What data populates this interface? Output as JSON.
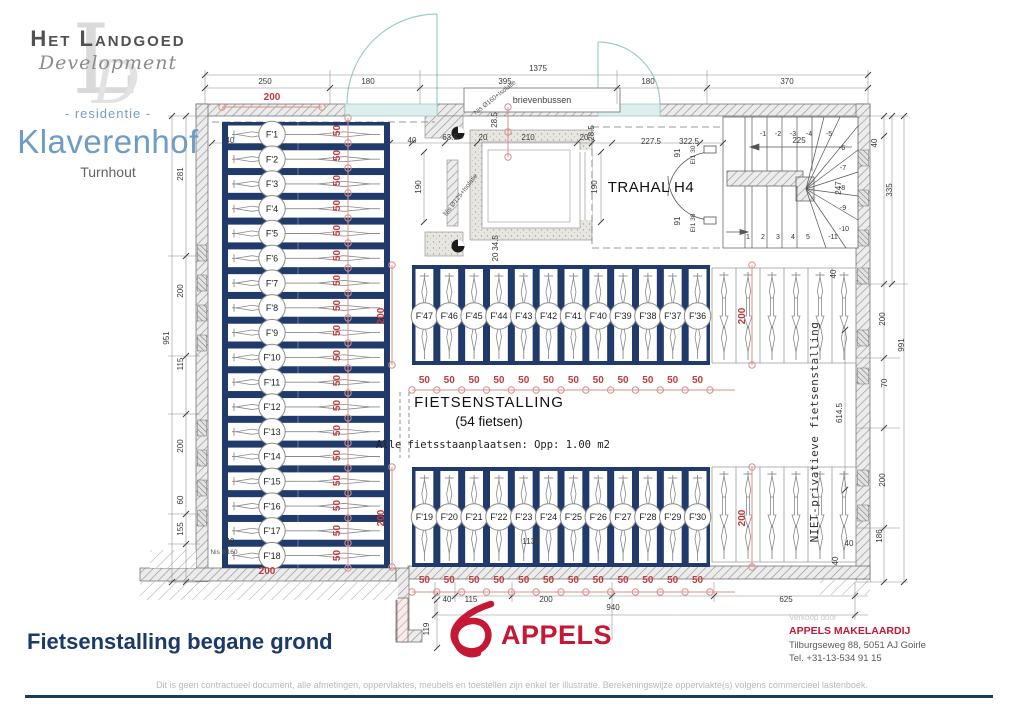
{
  "branding": {
    "company": "Het Landgoed",
    "development": "Development",
    "watermark1": "L",
    "watermark2": "D",
    "residentie": "- residentie -",
    "project": "Klaverenhof",
    "city": "Turnhout"
  },
  "title": "Fietsenstalling begane grond",
  "colors": {
    "navy": "#1f3a6b",
    "dim_red": "#c23b3b",
    "dim_red_light": "#d98f8a",
    "teal": "#9ccfce",
    "appels_red": "#c41834",
    "title_navy": "#1c3a69"
  },
  "plan": {
    "room_title": "FIETSENSTALLING",
    "room_subtitle": "(54 fietsen)",
    "room_note": "Alle fietsstaanplaatsen: Opp: 1.00 m2",
    "hall_label": "TRAHAL H4",
    "mailbox_label": "brievenbussen",
    "private_label": "NIET-privatieve fietsenstalling",
    "door_label": "EI1 30",
    "fifty": "50",
    "nis_labels": [
      {
        "t": "Nis Ø160+Isolatie",
        "x": 496,
        "y": 99,
        "r": -38
      },
      {
        "t": "Nis Ø125+Isolatie",
        "x": 462,
        "y": 196,
        "r": -52
      },
      {
        "t": "Nis Ø160",
        "x": 224,
        "y": 554,
        "r": 0
      }
    ],
    "left_stalls": [
      "F'1",
      "F'2",
      "F'3",
      "F'4",
      "F'5",
      "F'6",
      "F'7",
      "F'8",
      "F'9",
      "F'10",
      "F'11",
      "F'12",
      "F'13",
      "F'14",
      "F'15",
      "F'16",
      "F'17",
      "F'18"
    ],
    "top_stalls": [
      "F'47",
      "F'46",
      "F'45",
      "F'44",
      "F'43",
      "F'42",
      "F'41",
      "F'40",
      "F'39",
      "F'38",
      "F'37",
      "F'36"
    ],
    "bottom_stalls": [
      "F'19",
      "F'20",
      "F'21",
      "F'22",
      "F'23",
      "F'24",
      "F'25",
      "F'26",
      "F'27",
      "F'28",
      "F'29",
      "F'30"
    ],
    "stair_steps": {
      "top": [
        "-1",
        "-2",
        "-3",
        "-4",
        "-5"
      ],
      "right": [
        "-6",
        "-7",
        "-8",
        "-9",
        "-10",
        "-11"
      ],
      "bottom": [
        "1",
        "2",
        "3",
        "4",
        "5"
      ]
    },
    "red_dims": [
      {
        "t": "200",
        "x": 272,
        "y": 100
      },
      {
        "t": "200",
        "x": 267,
        "y": 574
      },
      {
        "t": "200",
        "x": 384,
        "y": 316,
        "r": -90
      },
      {
        "t": "200",
        "x": 384,
        "y": 518,
        "r": -90
      },
      {
        "t": "200",
        "x": 745,
        "y": 316,
        "r": -90
      },
      {
        "t": "200",
        "x": 745,
        "y": 518,
        "r": -90
      }
    ],
    "black_dims": [
      {
        "t": "1375",
        "x": 538,
        "y": 71
      },
      {
        "t": "250",
        "x": 265,
        "y": 84
      },
      {
        "t": "180",
        "x": 368,
        "y": 84
      },
      {
        "t": "395",
        "x": 505,
        "y": 84
      },
      {
        "t": "180",
        "x": 648,
        "y": 84
      },
      {
        "t": "370",
        "x": 787,
        "y": 84
      },
      {
        "t": "281",
        "x": 183,
        "y": 174,
        "r": -90
      },
      {
        "t": "200",
        "x": 183,
        "y": 291,
        "r": -90
      },
      {
        "t": "115",
        "x": 183,
        "y": 364,
        "r": -90
      },
      {
        "t": "200",
        "x": 183,
        "y": 446,
        "r": -90
      },
      {
        "t": "60",
        "x": 183,
        "y": 500,
        "r": -90
      },
      {
        "t": "155",
        "x": 183,
        "y": 529,
        "r": -90
      },
      {
        "t": "951",
        "x": 169,
        "y": 338,
        "r": -90
      },
      {
        "t": "40",
        "x": 877,
        "y": 143,
        "r": -90
      },
      {
        "t": "335",
        "x": 892,
        "y": 190,
        "r": -90
      },
      {
        "t": "200",
        "x": 885,
        "y": 319,
        "r": -90
      },
      {
        "t": "70",
        "x": 887,
        "y": 383,
        "r": -90
      },
      {
        "t": "200",
        "x": 885,
        "y": 480,
        "r": -90
      },
      {
        "t": "186",
        "x": 882,
        "y": 536,
        "r": -90
      },
      {
        "t": "991",
        "x": 904,
        "y": 345,
        "r": -90
      },
      {
        "t": "40",
        "x": 447,
        "y": 602
      },
      {
        "t": "115",
        "x": 471,
        "y": 602
      },
      {
        "t": "200",
        "x": 546,
        "y": 602
      },
      {
        "t": "625",
        "x": 786,
        "y": 602
      },
      {
        "t": "940",
        "x": 613,
        "y": 610
      },
      {
        "t": "119",
        "x": 429,
        "y": 629,
        "r": -90
      },
      {
        "t": "40",
        "x": 230,
        "y": 143
      },
      {
        "t": "40",
        "x": 412,
        "y": 143
      },
      {
        "t": "63.5",
        "x": 450,
        "y": 140
      },
      {
        "t": "20",
        "x": 483,
        "y": 140
      },
      {
        "t": "210",
        "x": 528,
        "y": 140
      },
      {
        "t": "20",
        "x": 584,
        "y": 140
      },
      {
        "t": "28.5",
        "x": 497,
        "y": 120,
        "r": -90
      },
      {
        "t": "28.5",
        "x": 594,
        "y": 133,
        "r": -90
      },
      {
        "t": "190",
        "x": 421,
        "y": 187,
        "r": -90
      },
      {
        "t": "190",
        "x": 597,
        "y": 187,
        "r": -90
      },
      {
        "t": "34.5",
        "x": 498,
        "y": 243,
        "r": -90
      },
      {
        "t": "20",
        "x": 498,
        "y": 257,
        "r": -90
      },
      {
        "t": "227.5",
        "x": 651,
        "y": 144
      },
      {
        "t": "322.5",
        "x": 689,
        "y": 144
      },
      {
        "t": "91",
        "x": 680,
        "y": 153,
        "r": -90
      },
      {
        "t": "91",
        "x": 680,
        "y": 221,
        "r": -90
      },
      {
        "t": "225",
        "x": 799,
        "y": 143
      },
      {
        "t": "247",
        "x": 841,
        "y": 188,
        "r": -90
      },
      {
        "t": "614.5",
        "x": 842,
        "y": 413,
        "r": -90
      },
      {
        "t": "1135",
        "x": 531,
        "y": 544
      },
      {
        "t": "40",
        "x": 836,
        "y": 274,
        "r": -90
      },
      {
        "t": "40",
        "x": 849,
        "y": 546
      },
      {
        "t": "40",
        "x": 838,
        "y": 561,
        "r": -90
      },
      {
        "t": "40",
        "x": 230,
        "y": 544
      }
    ]
  },
  "footer": {
    "disclaimer": "Dit is geen contractueel document, alle afmetingen, oppervlaktes, meubels en toestellen zijn enkel ter illustratie. Berekeningswijze oppervlakte(s) volgens commercieel lastenboek.",
    "verkoop_door": "Verkoop door",
    "agency": "APPELS MAKELAARDIJ",
    "address": "Tilburgseweg 88, 5051 AJ Goirle",
    "phone": "Tel. +31-13-534 91 15",
    "appels_logo_text": "APPELS"
  }
}
